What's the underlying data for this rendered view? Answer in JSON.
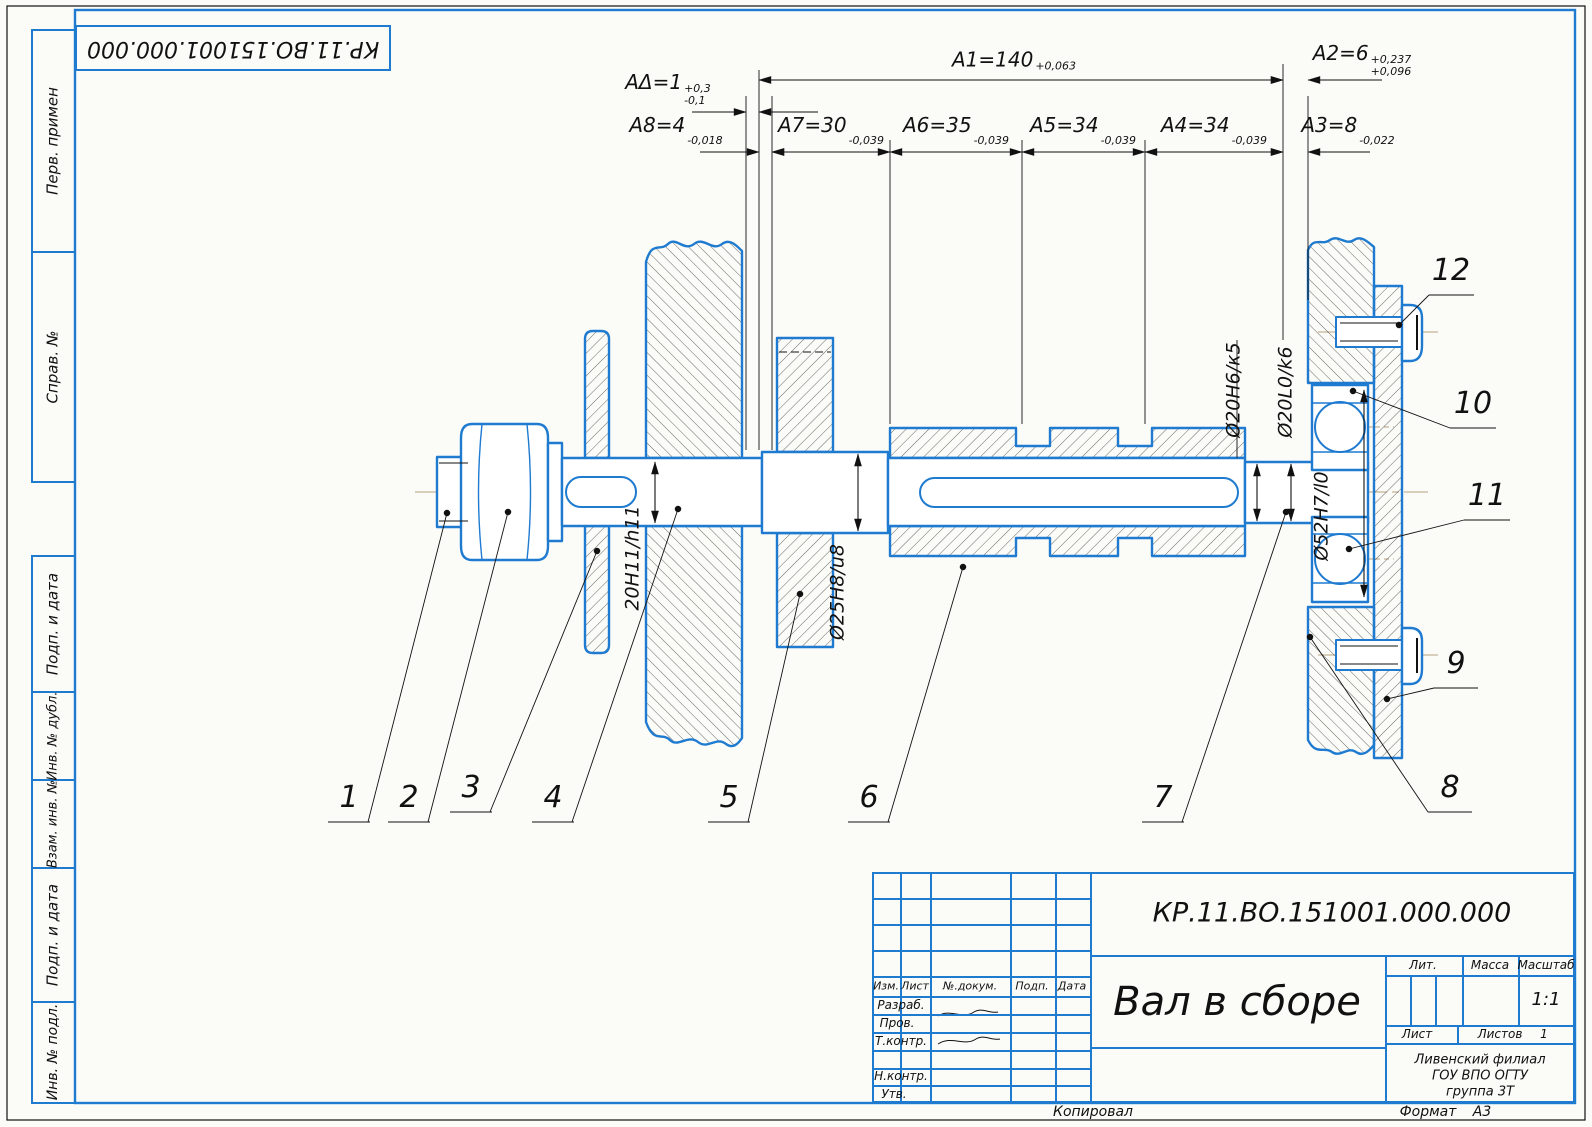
{
  "colors": {
    "line_blue": "#1f7bd0",
    "line_black": "#111111",
    "centerline_tan": "#c4b296",
    "paper": "#fbfbf8"
  },
  "corner_stamp": {
    "doc_number": "КР.11.ВО.151001.000.000"
  },
  "sidebar": {
    "items": [
      {
        "label": "Перв. примен"
      },
      {
        "label": "Справ. №"
      },
      {
        "label": "Подп. и дата"
      },
      {
        "label": "Инв. № дубл."
      },
      {
        "label": "Взам. инв. №"
      },
      {
        "label": "Подп. и дата"
      },
      {
        "label": "Инв. № подл."
      }
    ]
  },
  "dimensions": {
    "a_delta": {
      "base": "AΔ=1",
      "sup": "+0,3",
      "sub": "-0,1"
    },
    "a1": {
      "base": "A1=140",
      "sup": "+0,063",
      "sub": ""
    },
    "a2": {
      "base": "A2=6",
      "sup": "+0,237",
      "sub": "+0,096"
    },
    "a3": {
      "base": "A3=8",
      "sup": "",
      "sub": "-0,022"
    },
    "a4": {
      "base": "A4=34",
      "sup": "",
      "sub": "-0,039"
    },
    "a5": {
      "base": "A5=34",
      "sup": "",
      "sub": "-0,039"
    },
    "a6": {
      "base": "A6=35",
      "sup": "",
      "sub": "-0,039"
    },
    "a7": {
      "base": "A7=30",
      "sup": "",
      "sub": "-0,039"
    },
    "a8": {
      "base": "A8=4",
      "sup": "",
      "sub": "-0,018"
    }
  },
  "fits": {
    "left_seat": "20Н11/h11",
    "hub_seat": "Ø25Н8/u8",
    "right_seat": "Ø20Н6/к5",
    "bearing_seat": "Ø20L0/k6",
    "bearing_housing": "Ø52Н7/l0"
  },
  "callouts": {
    "c1": "1",
    "c2": "2",
    "c3": "3",
    "c4": "4",
    "c5": "5",
    "c6": "6",
    "c7": "7",
    "c8": "8",
    "c9": "9",
    "c10": "10",
    "c11": "11",
    "c12": "12"
  },
  "title_block": {
    "doc_number": "КР.11.ВО.151001.000.000",
    "title": "Вал в сборе",
    "headers": {
      "izm": "Изм.",
      "list": "Лист",
      "doc": "№.докум.",
      "podp": "Подп.",
      "data": "Дата"
    },
    "rows": {
      "razrab": "Разраб.",
      "prov": "Пров.",
      "tkontr": "Т.контр.",
      "nkontr": "Н.контр.",
      "utv": "Утв."
    },
    "lit_label": "Лит.",
    "massa_label": "Масса",
    "masshtab_label": "Масштаб",
    "scale": "1:1",
    "list_label": "Лист",
    "listov_label": "Листов",
    "listov_value": "1",
    "org_line1": "Ливенский филиал",
    "org_line2": "ГОУ ВПО ОГТУ",
    "org_line3": "группа 3Т"
  },
  "margin": {
    "copied_label": "Копировал",
    "format_label": "Формат",
    "format_value": "А3"
  }
}
